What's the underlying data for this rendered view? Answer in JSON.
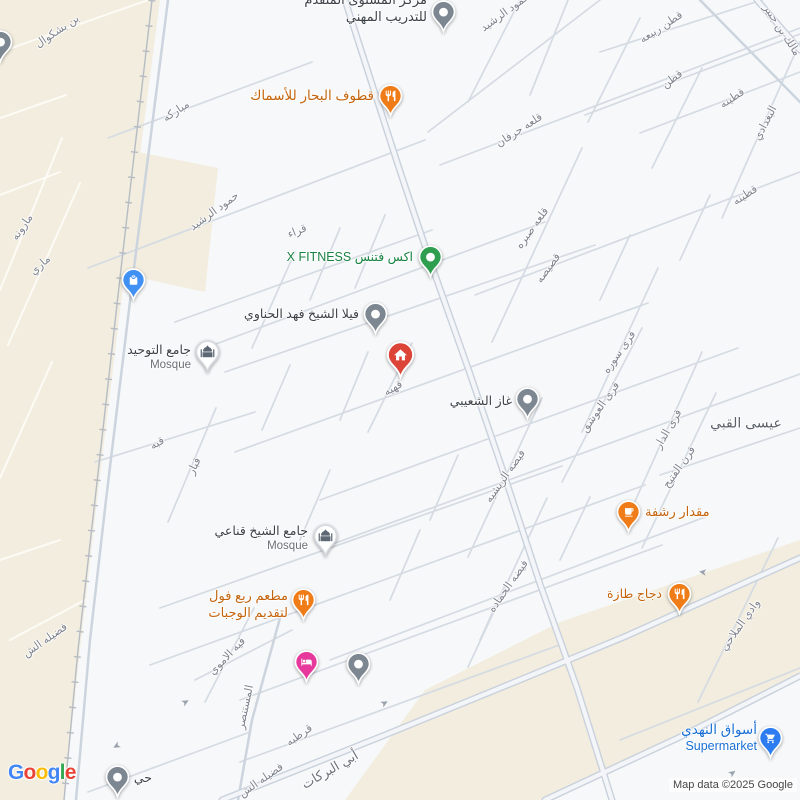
{
  "map": {
    "attribution": "Map data ©2025 Google",
    "logo_letters": [
      {
        "char": "G",
        "color": "#4285F4"
      },
      {
        "char": "o",
        "color": "#EA4335"
      },
      {
        "char": "o",
        "color": "#FBBC05"
      },
      {
        "char": "g",
        "color": "#4285F4"
      },
      {
        "char": "l",
        "color": "#34A853"
      },
      {
        "char": "e",
        "color": "#EA4335"
      }
    ],
    "colors": {
      "dark": "#3c4248",
      "orange": "#c4640d",
      "green": "#178242",
      "blue": "#1a6fd4",
      "muted": "#6b7077",
      "street": "#7f838e",
      "area": "#5c616b",
      "beige": "#f2edde",
      "road": "#d5dbe3",
      "road_major": "#c9d1dc",
      "railway": "#b6bcc4"
    },
    "pins": [
      {
        "name": "training-center-pin",
        "x": 443,
        "y": 12,
        "icon": "dot",
        "color": "#7c8792",
        "size": 27
      },
      {
        "name": "seafood-restaurant-pin",
        "x": 390,
        "y": 96,
        "icon": "restaurant",
        "color": "#ef7c16",
        "size": 27
      },
      {
        "name": "shopping-pin",
        "x": 133,
        "y": 280,
        "icon": "bag",
        "color": "#4191f5",
        "size": 27
      },
      {
        "name": "fitness-pin",
        "x": 430,
        "y": 257,
        "icon": "dot",
        "color": "#2f9e4e",
        "size": 27
      },
      {
        "name": "villa-pin",
        "x": 375,
        "y": 314,
        "icon": "dot",
        "color": "#7c8792",
        "size": 27
      },
      {
        "name": "mosque-tawhid-pin",
        "x": 207,
        "y": 352,
        "icon": "mosque",
        "color": "#ffffff",
        "size": 27
      },
      {
        "name": "home-pin",
        "x": 400,
        "y": 355,
        "icon": "home",
        "color": "#db4437",
        "size": 31
      },
      {
        "name": "gas-station-pin",
        "x": 527,
        "y": 399,
        "icon": "dot",
        "color": "#7c8792",
        "size": 27
      },
      {
        "name": "cafe-pin",
        "x": 628,
        "y": 512,
        "icon": "coffee",
        "color": "#ef7c16",
        "size": 27
      },
      {
        "name": "mosque-qnaei-pin",
        "x": 325,
        "y": 536,
        "icon": "mosque",
        "color": "#ffffff",
        "size": 27
      },
      {
        "name": "foul-restaurant-pin",
        "x": 303,
        "y": 600,
        "icon": "restaurant",
        "color": "#ef7c16",
        "size": 27
      },
      {
        "name": "hotel-pin",
        "x": 306,
        "y": 662,
        "icon": "bed",
        "color": "#e6399b",
        "size": 27
      },
      {
        "name": "generic-poi-pin",
        "x": 358,
        "y": 664,
        "icon": "dot",
        "color": "#7c8792",
        "size": 27
      },
      {
        "name": "chicken-restaurant-pin",
        "x": 679,
        "y": 594,
        "icon": "restaurant",
        "color": "#ef7c16",
        "size": 27
      },
      {
        "name": "supermarket-pin",
        "x": 770,
        "y": 738,
        "icon": "cart",
        "color": "#2e7df0",
        "size": 27
      },
      {
        "name": "generic-poi-pin",
        "x": 117,
        "y": 777,
        "icon": "dot",
        "color": "#7c8792",
        "size": 27
      },
      {
        "name": "generic-poi-pin",
        "x": 0,
        "y": 42,
        "icon": "dot",
        "color": "#7c8792",
        "size": 27
      }
    ],
    "poi_labels": [
      {
        "name": "training-center-label",
        "lines": [
          "مركز المستوى المتقدم",
          "للتدريب المهني"
        ],
        "x": 427,
        "y": -8,
        "anchor": "right",
        "color": "dark",
        "size": 13,
        "sub_color": "dark",
        "sub_size": 13
      },
      {
        "name": "seafood-restaurant-label",
        "lines": [
          "قطوف البحار للأسماك"
        ],
        "x": 374,
        "y": 87,
        "anchor": "right",
        "color": "orange",
        "size": 13.5
      },
      {
        "name": "fitness-label",
        "lines": [
          "اكس فتنس X FITNESS"
        ],
        "x": 413,
        "y": 249,
        "anchor": "right",
        "color": "green",
        "size": 12.5
      },
      {
        "name": "villa-label",
        "lines": [
          "فيلا الشيخ فهد الحناوي"
        ],
        "x": 359,
        "y": 306,
        "anchor": "right",
        "color": "dark",
        "size": 12.5
      },
      {
        "name": "mosque-tawhid-label",
        "lines": [
          "جامع التوحيد",
          "Mosque"
        ],
        "x": 191,
        "y": 342,
        "anchor": "right",
        "color": "dark",
        "size": 12.5,
        "sub_color": "muted",
        "sub_size": 11.5
      },
      {
        "name": "gas-station-label",
        "lines": [
          "غاز الشعيبي"
        ],
        "x": 512,
        "y": 393,
        "anchor": "right",
        "color": "dark",
        "size": 12.5
      },
      {
        "name": "cafe-label",
        "lines": [
          "مقدار رشفة"
        ],
        "x": 645,
        "y": 504,
        "anchor": "left",
        "color": "orange",
        "size": 13
      },
      {
        "name": "mosque-qnaei-label",
        "lines": [
          "جامع الشيخ قناعي",
          "Mosque"
        ],
        "x": 308,
        "y": 523,
        "anchor": "right",
        "color": "dark",
        "size": 12.5,
        "sub_color": "muted",
        "sub_size": 11.5
      },
      {
        "name": "foul-restaurant-label",
        "lines": [
          "مطعم ربع فول",
          "لتقديم الوجبات"
        ],
        "x": 288,
        "y": 588,
        "anchor": "right",
        "color": "orange",
        "size": 13,
        "sub_color": "orange",
        "sub_size": 13
      },
      {
        "name": "chicken-restaurant-label",
        "lines": [
          "دجاج طازة"
        ],
        "x": 662,
        "y": 586,
        "anchor": "right",
        "color": "orange",
        "size": 12.5
      },
      {
        "name": "supermarket-label",
        "lines": [
          "أسواق النهدي",
          "Supermarket"
        ],
        "x": 757,
        "y": 721,
        "anchor": "right",
        "color": "blue",
        "size": 13.5,
        "sub_color": "blue",
        "sub_size": 12.5
      },
      {
        "name": "district-label",
        "lines": [
          "حي"
        ],
        "x": 152,
        "y": 770,
        "anchor": "right",
        "color": "dark",
        "size": 12.5
      }
    ],
    "street_labels": [
      {
        "text": "بن بشكوال",
        "x": 57,
        "y": 31,
        "rot": -34
      },
      {
        "text": "مباركه",
        "x": 176,
        "y": 111,
        "rot": -33
      },
      {
        "text": "مارونه",
        "x": 22,
        "y": 227,
        "rot": -55
      },
      {
        "text": "ماري",
        "x": 40,
        "y": 265,
        "rot": -42
      },
      {
        "text": "حمود الرشيد",
        "x": 214,
        "y": 211,
        "rot": -36
      },
      {
        "text": "حمود الرشيد",
        "x": 505,
        "y": 12,
        "rot": -36
      },
      {
        "text": "قراء",
        "x": 297,
        "y": 231,
        "rot": -22
      },
      {
        "text": "قطن ربيعه",
        "x": 661,
        "y": 27,
        "rot": -33
      },
      {
        "text": "قطن",
        "x": 672,
        "y": 79,
        "rot": -36
      },
      {
        "text": "قطينه",
        "x": 732,
        "y": 98,
        "rot": -33
      },
      {
        "text": "البغدادي",
        "x": 765,
        "y": 123,
        "rot": -62
      },
      {
        "text": "قطينه",
        "x": 745,
        "y": 195,
        "rot": -33
      },
      {
        "text": "مالك بن جبير",
        "x": 782,
        "y": 30,
        "rot": 57
      },
      {
        "text": "قلعه جرفان",
        "x": 519,
        "y": 130,
        "rot": -33
      },
      {
        "text": "قلعه صبره",
        "x": 532,
        "y": 228,
        "rot": -54
      },
      {
        "text": "قصيصه",
        "x": 548,
        "y": 268,
        "rot": -54
      },
      {
        "text": "قرى سوره",
        "x": 619,
        "y": 352,
        "rot": -55
      },
      {
        "text": "قرى العوشق",
        "x": 600,
        "y": 407,
        "rot": -55
      },
      {
        "text": "قرى الدار",
        "x": 668,
        "y": 429,
        "rot": -60
      },
      {
        "text": "قرن الفتيح",
        "x": 679,
        "y": 467,
        "rot": -55
      },
      {
        "text": "قهيه",
        "x": 393,
        "y": 388,
        "rot": -30
      },
      {
        "text": "قبه",
        "x": 157,
        "y": 443,
        "rot": -30
      },
      {
        "text": "قبار",
        "x": 194,
        "y": 466,
        "rot": -64
      },
      {
        "text": "فيضه الريشيه",
        "x": 505,
        "y": 476,
        "rot": -55
      },
      {
        "text": "فيضه الحماده",
        "x": 508,
        "y": 586,
        "rot": -55
      },
      {
        "text": "فضيله الش",
        "x": 45,
        "y": 640,
        "rot": -35
      },
      {
        "text": "فيه الاموي",
        "x": 227,
        "y": 656,
        "rot": -46
      },
      {
        "text": "المستنصر",
        "x": 245,
        "y": 707,
        "rot": -78
      },
      {
        "text": "قرطبه",
        "x": 299,
        "y": 735,
        "rot": -35
      },
      {
        "text": "فضيله الش",
        "x": 261,
        "y": 780,
        "rot": -35
      },
      {
        "text": "وادي الملاحي",
        "x": 740,
        "y": 625,
        "rot": -55
      },
      {
        "text": "أبي البركات",
        "x": 330,
        "y": 770,
        "rot": -30,
        "size": 13,
        "color": "#6d717b"
      },
      {
        "text": "عيسى القبي",
        "x": 746,
        "y": 423,
        "rot": 0,
        "size": 14,
        "color": "#5c616b"
      }
    ],
    "arrows": [
      {
        "x": 186,
        "y": 703,
        "rot": -30
      },
      {
        "x": 116,
        "y": 745,
        "rot": 150
      },
      {
        "x": 703,
        "y": 571,
        "rot": 188
      },
      {
        "x": 733,
        "y": 774,
        "rot": -35
      },
      {
        "x": 385,
        "y": 704,
        "rot": -30
      }
    ]
  }
}
